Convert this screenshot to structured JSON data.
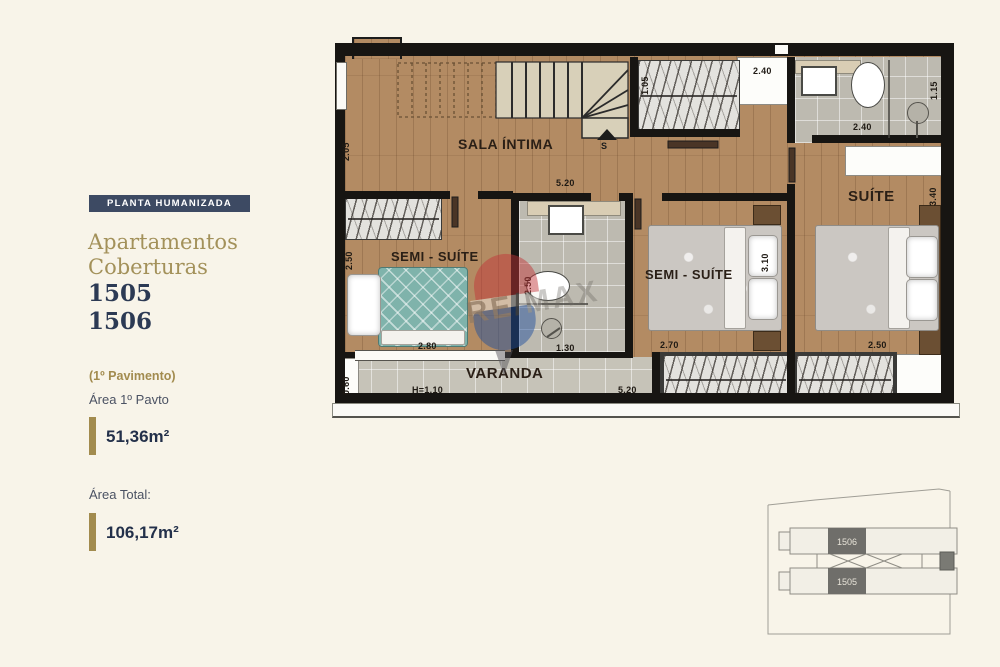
{
  "sidebar": {
    "badge": "PLANTA HUMANIZADA",
    "title_line1": "Apartamentos",
    "title_line2": "Coberturas",
    "unit1": "1505",
    "unit2": "1506",
    "floor_note": "(1º Pavimento)",
    "area_label": "Área 1º Pavto",
    "area_value": "51,36m²",
    "total_label": "Área Total:",
    "total_value": "106,17m²"
  },
  "plan": {
    "stair_label": "S",
    "rooms": [
      {
        "label": "SALA ÍNTIMA",
        "x": 458,
        "y": 136,
        "size": 14
      },
      {
        "label": "SEMI - SUÍTE",
        "x": 391,
        "y": 249,
        "size": 13
      },
      {
        "label": "SEMI - SUÍTE",
        "x": 645,
        "y": 267,
        "size": 13
      },
      {
        "label": "SUÍTE",
        "x": 848,
        "y": 188,
        "size": 15
      },
      {
        "label": "VARANDA",
        "x": 466,
        "y": 365,
        "size": 15
      }
    ],
    "dimensions": [
      {
        "text": "2.05",
        "x": 341,
        "y": 161,
        "rot": true
      },
      {
        "text": "5.20",
        "x": 556,
        "y": 178
      },
      {
        "text": "1.05",
        "x": 640,
        "y": 95,
        "rot": true
      },
      {
        "text": "2.40",
        "x": 753,
        "y": 66
      },
      {
        "text": "2.40",
        "x": 853,
        "y": 122
      },
      {
        "text": "1.15",
        "x": 929,
        "y": 100,
        "rot": true
      },
      {
        "text": "3.40",
        "x": 928,
        "y": 206,
        "rot": true
      },
      {
        "text": "2.50",
        "x": 344,
        "y": 270,
        "rot": true
      },
      {
        "text": "2.50",
        "x": 523,
        "y": 295,
        "rot": true
      },
      {
        "text": "3.10",
        "x": 760,
        "y": 272,
        "rot": true
      },
      {
        "text": "2.80",
        "x": 418,
        "y": 341
      },
      {
        "text": "1.30",
        "x": 556,
        "y": 343
      },
      {
        "text": "2.70",
        "x": 660,
        "y": 340
      },
      {
        "text": "2.50",
        "x": 868,
        "y": 340
      },
      {
        "text": "0.60",
        "x": 341,
        "y": 395,
        "rot": true
      },
      {
        "text": "H=1.10",
        "x": 412,
        "y": 385
      },
      {
        "text": "5.20",
        "x": 618,
        "y": 385
      }
    ]
  },
  "watermark": {
    "brand": "RE/MAX"
  },
  "miniplan": {
    "unit_top": "1506",
    "unit_bottom": "1505"
  }
}
